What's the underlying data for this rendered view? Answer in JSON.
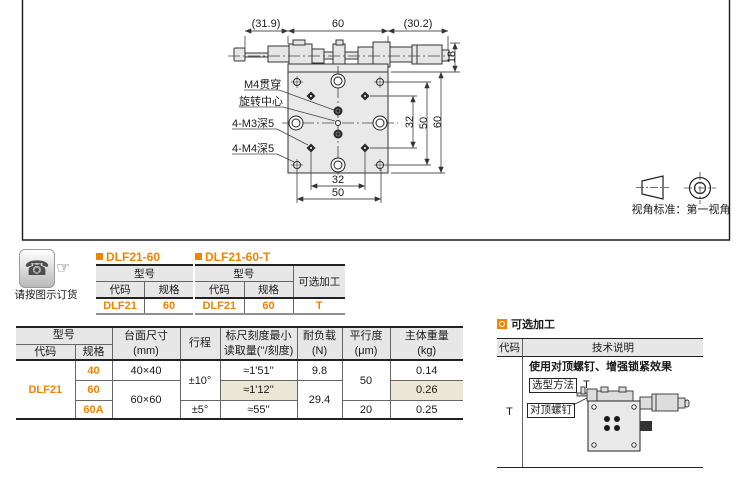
{
  "colors": {
    "accent_orange": "#f08300",
    "header_gray": "#e7e7e7",
    "highlight_beige": "#ebe7d6"
  },
  "icons": {
    "phone": "☎",
    "hand": "☞"
  },
  "drawing": {
    "dim_left": "(31.9)",
    "dim_center": "60",
    "dim_right": "(30.2)",
    "dim_height": "18",
    "label_m4_through": "M4贯穿",
    "label_rotation_center": "旋转中心",
    "label_m3_deep": "4-M3深5",
    "label_m4_deep": "4-M4深5",
    "dim_v32": "32",
    "dim_v50": "50",
    "dim_v60": "60",
    "dim_h32": "32",
    "dim_h50": "50",
    "view_standard": "视角标准：第一视角"
  },
  "order": {
    "note": "请按图示订货",
    "tables": [
      {
        "title": "DLF21-60",
        "model_header": "型号",
        "col_code": "代码",
        "col_spec": "规格",
        "code": "DLF21",
        "spec": "60"
      },
      {
        "title": "DLF21-60-T",
        "model_header": "型号",
        "col_code": "代码",
        "col_spec": "规格",
        "option_header": "可选加工",
        "code": "DLF21",
        "spec": "60",
        "option": "T"
      }
    ]
  },
  "spec": {
    "headers": {
      "model": "型号",
      "code": "代码",
      "spec": "规格",
      "size_l1": "台面尺寸",
      "size_l2": "(mm)",
      "travel": "行程",
      "scale_l1": "标尺刻度最小",
      "scale_l2": "读取量(''/刻度)",
      "load_l1": "耐负载",
      "load_l2": "(N)",
      "parallel_l1": "平行度",
      "parallel_l2": "(μm)",
      "weight_l1": "主体重量",
      "weight_l2": "(kg)"
    },
    "code": "DLF21",
    "rows": [
      {
        "spec": "40",
        "size": "40×40",
        "travel": "±10°",
        "scale": "≈1'51''",
        "load": "9.8",
        "parallel": "50",
        "weight": "0.14"
      },
      {
        "spec": "60",
        "size": "60×60",
        "scale": "≈1'12''",
        "load": "29.4",
        "weight": "0.26"
      },
      {
        "spec": "60A",
        "travel": "±5°",
        "scale": "≈55''",
        "parallel": "20",
        "weight": "0.25"
      }
    ]
  },
  "optional": {
    "title": "可选加工",
    "col_code": "代码",
    "col_desc": "技术说明",
    "code": "T",
    "desc_title": "使用对顶螺钉、增强锁紧效果",
    "method_label": "选型方法",
    "method_value": "T",
    "screw_label": "对顶螺钉"
  }
}
